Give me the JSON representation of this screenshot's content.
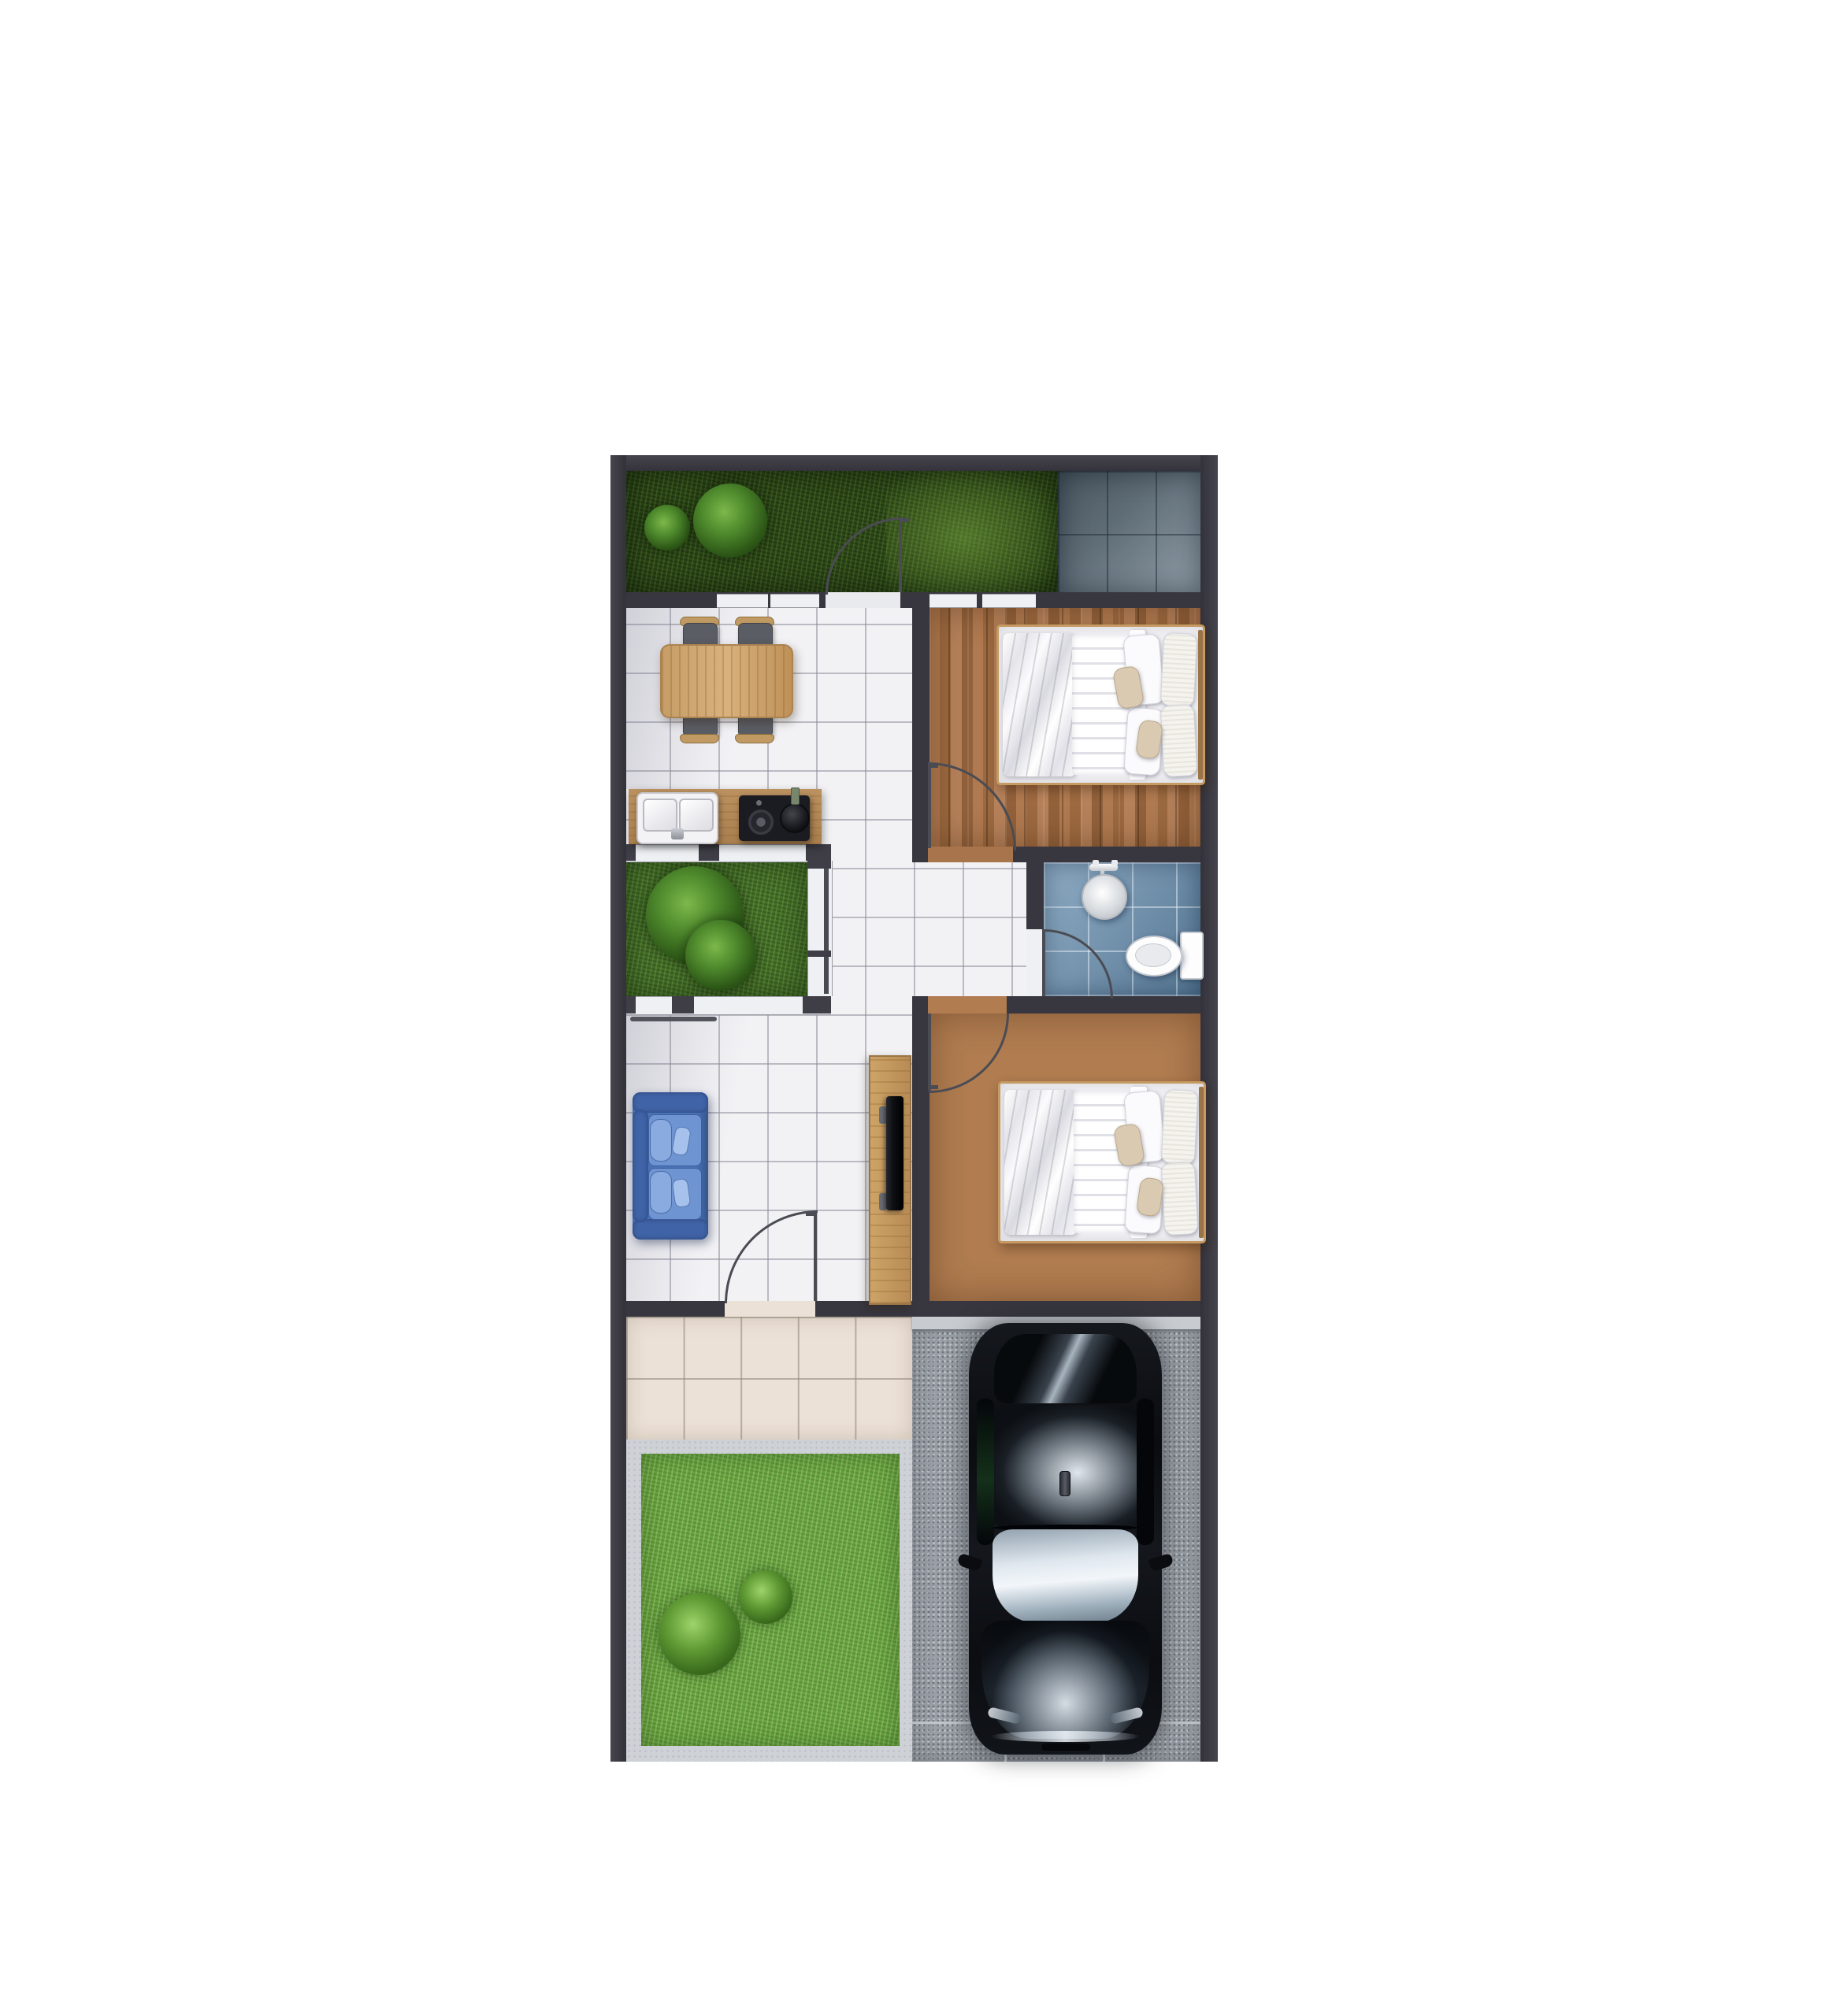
{
  "scene": {
    "kind": "3d-rendered residential floor plan, top-down view, centered on white background",
    "background_color": "#ffffff",
    "wall_color": "#38373f",
    "no_visible_text": true
  },
  "rooms": [
    {
      "name": "back-garden-strip",
      "floor": "grass",
      "color": "#2d4818",
      "features": [
        "bush-small",
        "bush-large",
        "garden-door-with-swing-arc"
      ]
    },
    {
      "name": "side-patio",
      "floor": "slate-tiles",
      "color": "#66747f"
    },
    {
      "name": "dining-room",
      "floor": "white-ceramic-tile",
      "color": "#f2f2f5",
      "furniture": [
        "dining-table-wood",
        "chair x4"
      ]
    },
    {
      "name": "kitchen",
      "floor": "white-ceramic-tile",
      "furniture": [
        "wood-counter",
        "double-sink-with-faucet",
        "two-burner-stove-with-pot"
      ]
    },
    {
      "name": "bedroom-1",
      "floor": "wood-planks",
      "color": "#a8744b",
      "furniture": [
        "double-bed",
        "blanket",
        "quilt",
        "pillows x6"
      ],
      "door": "swing-into-room-from-hallway",
      "windows": 2
    },
    {
      "name": "inner-courtyard",
      "floor": "grass",
      "color": "#447029",
      "features": [
        "bush-large",
        "bush-small"
      ],
      "windows": "white sill bands on three sides"
    },
    {
      "name": "hallway",
      "floor": "white-ceramic-tile"
    },
    {
      "name": "bathroom",
      "floor": "blue-ceramic-tile",
      "color": "#6f94b3",
      "fixtures": [
        "shower-head-round",
        "shower-valve-bar",
        "toilet-with-tank"
      ],
      "door": "swing-into-room-from-hallway"
    },
    {
      "name": "living-room",
      "floor": "white-ceramic-tile",
      "furniture": [
        "sofa-blue-two-seat",
        "tv-cabinet-wood",
        "tv-black"
      ],
      "door": "front-door-with-swing-arc"
    },
    {
      "name": "bedroom-2",
      "floor": "wood-planks",
      "color": "#b07c50",
      "furniture": [
        "double-bed",
        "blanket",
        "quilt",
        "pillows x6"
      ],
      "door": "swing-into-room-from-hallway"
    },
    {
      "name": "front-porch",
      "floor": "beige-tiles",
      "color": "#ece1d6"
    },
    {
      "name": "front-yard",
      "floor": "grass-with-concrete-border",
      "color": "#69a441",
      "features": [
        "bush-large",
        "bush-small"
      ]
    },
    {
      "name": "carport-driveway",
      "floor": "gravel",
      "color": "#9ca2a8",
      "features": [
        "expansion-joint-lines",
        "parked-car"
      ]
    }
  ],
  "vehicle": {
    "name": "black-sedan-top-view",
    "body_color": "#0b0d11",
    "details": [
      "rear-windshield-sky-reflection",
      "roof-cloud-reflection",
      "shark-fin-antenna",
      "bright-windshield",
      "hood-cloud-reflection",
      "side-mirrors",
      "headlights",
      "front-bumper-highlight"
    ]
  },
  "palette": {
    "wall": "#38373f",
    "white_tile": "#f2f2f5",
    "wood_floor": "#a8744b",
    "grass_dark": "#2d4818",
    "grass_mid": "#447029",
    "grass_bright": "#69a441",
    "patio_slate": "#66747f",
    "bath_blue": "#6f94b3",
    "porch_beige": "#ece1d6",
    "gravel": "#9ca2a8",
    "concrete": "#ced2d7",
    "sofa_blue": "#4a72b4",
    "furniture_wood": "#c89e66",
    "door_line": "#4b4c53"
  }
}
